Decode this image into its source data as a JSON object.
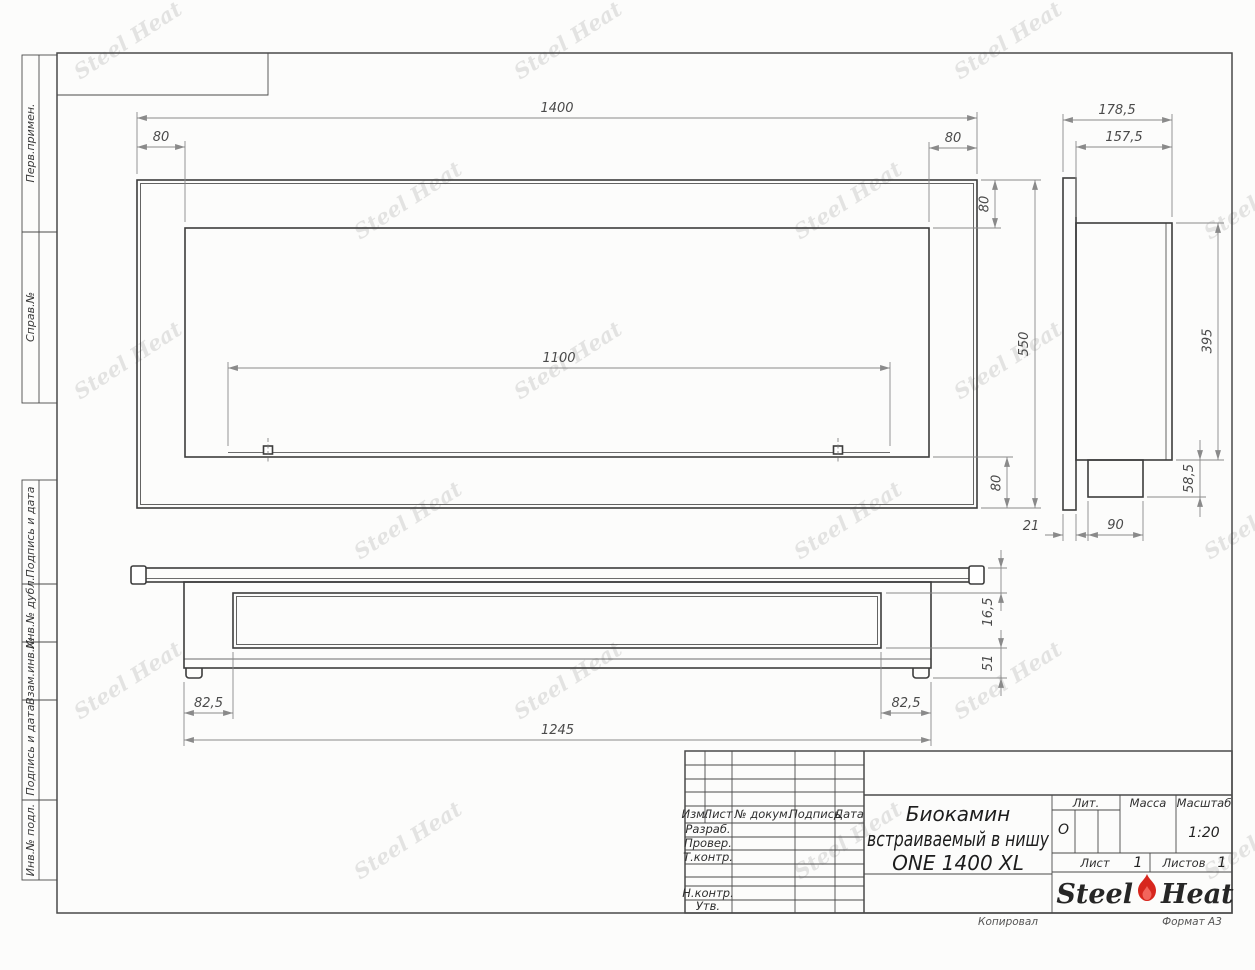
{
  "sheet": {
    "side_labels": [
      {
        "label": "Перв.примен."
      },
      {
        "label": "Справ.№"
      },
      {
        "label": "Подпись и дата"
      },
      {
        "label": "Инв.№ дубл."
      },
      {
        "label": "Взам.инв.№"
      },
      {
        "label": "Подпись и дата"
      },
      {
        "label": "Инв.№ подл."
      }
    ],
    "footer": {
      "copied": "Копировал",
      "format": "Формат А3"
    }
  },
  "watermark": {
    "text": "Steel Heat"
  },
  "front_view": {
    "dim_width": "1400",
    "dim_left_offset": "80",
    "dim_right_offset": "80",
    "dim_burner": "1100",
    "dim_height": "550",
    "dim_top_offset": "80",
    "dim_bottom_offset": "80"
  },
  "side_view": {
    "dim_depth": "178,5",
    "dim_body_depth": "157,5",
    "dim_inner_height": "395",
    "dim_tray_height": "58,5",
    "dim_tray_depth": "90",
    "dim_flange": "21"
  },
  "bottom_view": {
    "dim_body_width": "1245",
    "dim_left_offset": "82,5",
    "dim_right_offset": "82,5",
    "dim_flange": "16,5",
    "dim_base": "51"
  },
  "title_block": {
    "rev_columns": {
      "izm": "Изм.",
      "list": "Лист",
      "doc": "№ докум.",
      "sign": "Подпись",
      "date": "Дата"
    },
    "roles": {
      "developed": "Разраб.",
      "checked": "Провер.",
      "tcontrol": "Т.контр.",
      "ncontrol": "Н.контр.",
      "approved": "Утв."
    },
    "title_line1": "Биокамин",
    "title_line2": "встраиваемый в нишу",
    "title_line3": "ONE 1400 XL",
    "lit_label": "Лит.",
    "lit_value": "О",
    "mass_label": "Масса",
    "scale_label": "Масштаб",
    "scale_value": "1:20",
    "sheet_label": "Лист",
    "sheet_value": "1",
    "sheets_label": "Листов",
    "sheets_value": "1",
    "logo": {
      "steel": "Steel",
      "heat": "Heat"
    }
  }
}
